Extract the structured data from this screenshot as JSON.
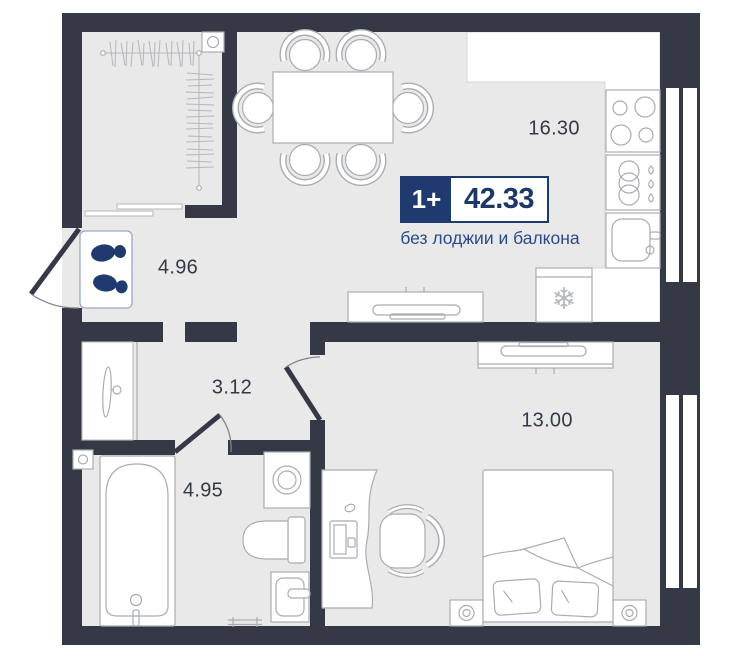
{
  "plan": {
    "badge": {
      "rooms_count": "1+",
      "total_area": "42.33",
      "note": "без лоджии и балкона"
    },
    "rooms": {
      "kitchen_living": {
        "area": "16.30"
      },
      "hallway": {
        "area": "4.96"
      },
      "corridor": {
        "area": "3.12"
      },
      "bathroom": {
        "area": "4.95"
      },
      "bedroom": {
        "area": "13.00"
      }
    },
    "icons": {
      "snowflake": "❄"
    },
    "colors": {
      "wall": "#343945",
      "floor": "#e9e9ea",
      "accent_navy": "#1e3a6e",
      "furniture_line": "#a9adb2",
      "note_blue": "#2b4a8a",
      "label_dark": "#333a46"
    }
  }
}
